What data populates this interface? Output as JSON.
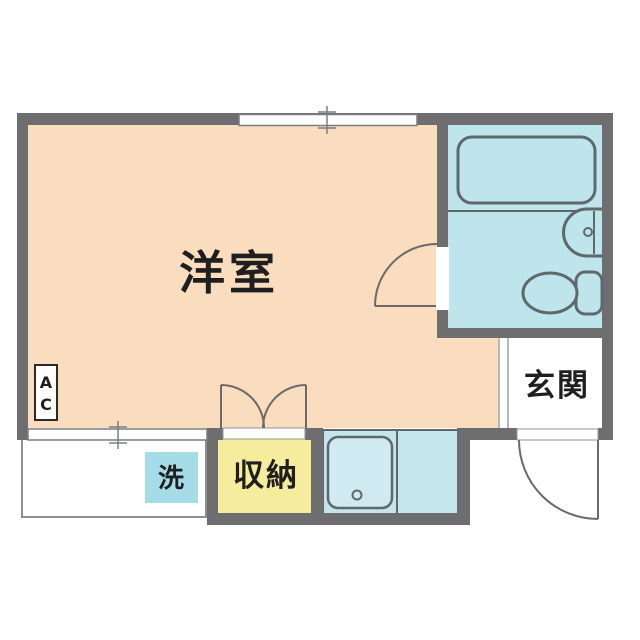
{
  "plan": {
    "type": "apartment-floor-plan",
    "labels": {
      "main_room": "洋室",
      "entrance": "玄関",
      "storage": "収納",
      "laundry": "洗",
      "ac_line1": "A",
      "ac_line2": "C"
    },
    "colors": {
      "wall": "#6E6E70",
      "main_room": "#FADCBE",
      "bathroom": "#BEE4EC",
      "kitchen": "#C3E5EB",
      "kitchen_sink": "#CFEAF0",
      "laundry": "#A6DBE8",
      "storage": "#F6EC9E",
      "fixture_outline": "#5F696C",
      "text": "#1F1F1F"
    }
  }
}
